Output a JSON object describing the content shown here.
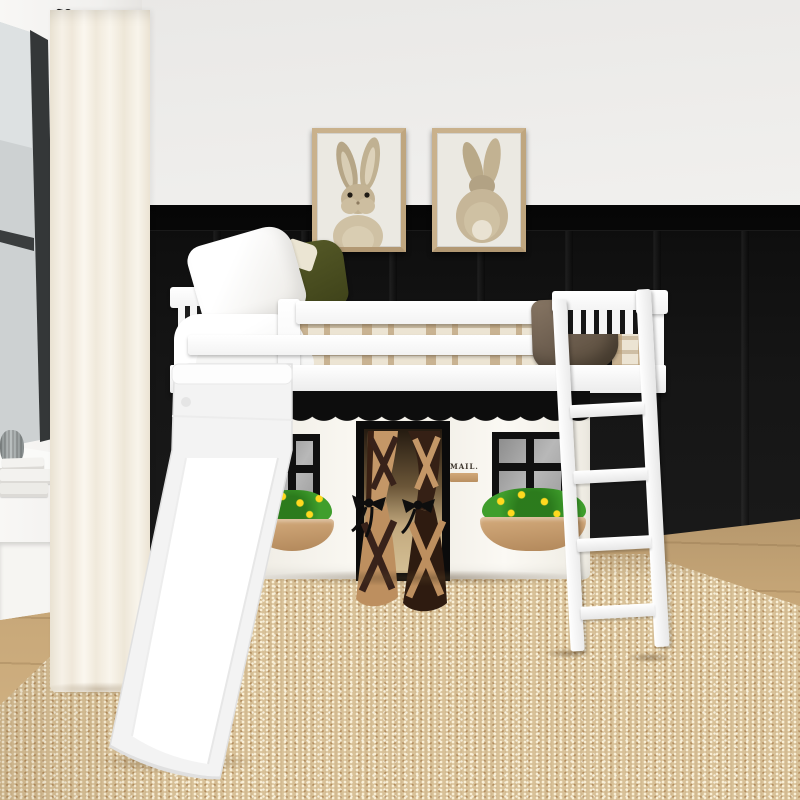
{
  "scene": {
    "type": "product-photo",
    "subject": "Kids low loft bed with slide, angled ladder and farmhouse playhouse curtain",
    "setting": "Bedroom with white upper wall, black board-and-batten wainscot, light wood floor, jute area rug, side window with sheer white curtain on black rod"
  },
  "wall_art": {
    "left_print": "bunny front portrait in light wood frame",
    "right_print": "bunny back portrait in light wood frame"
  },
  "bed": {
    "frame_color": "#ffffff",
    "pillows": [
      "white",
      "olive-green"
    ],
    "bedding": "tan plaid",
    "blanket": "brown",
    "accessories": [
      "white slide",
      "white angled ladder"
    ]
  },
  "playhouse": {
    "fabric_color": "#f6f3ec",
    "awning": "black scalloped",
    "windows": 2,
    "window_panes": "2x2 gray",
    "window_boxes": "tan planters with green shrubs and yellow flowers",
    "door": "barn-style tied curtains, tan and dark brown with crossbuck straps",
    "mail_sign": "MAIL."
  },
  "palette": {
    "upper_wall": "#f1f0ee",
    "wainscot": "#141414",
    "wood_floor": "#c7a778",
    "rug": "#d8c198",
    "bed_white": "#ffffff",
    "olive_pillow": "#4c5022",
    "brown_blanket": "#6e5f4f",
    "door_tan": "#c49767",
    "door_brown": "#352015",
    "bush_green": "#3f9e2c",
    "flower_yellow": "#ffd91f",
    "planter_tan": "#c79e6e",
    "frame_wood": "#c9b18c"
  }
}
